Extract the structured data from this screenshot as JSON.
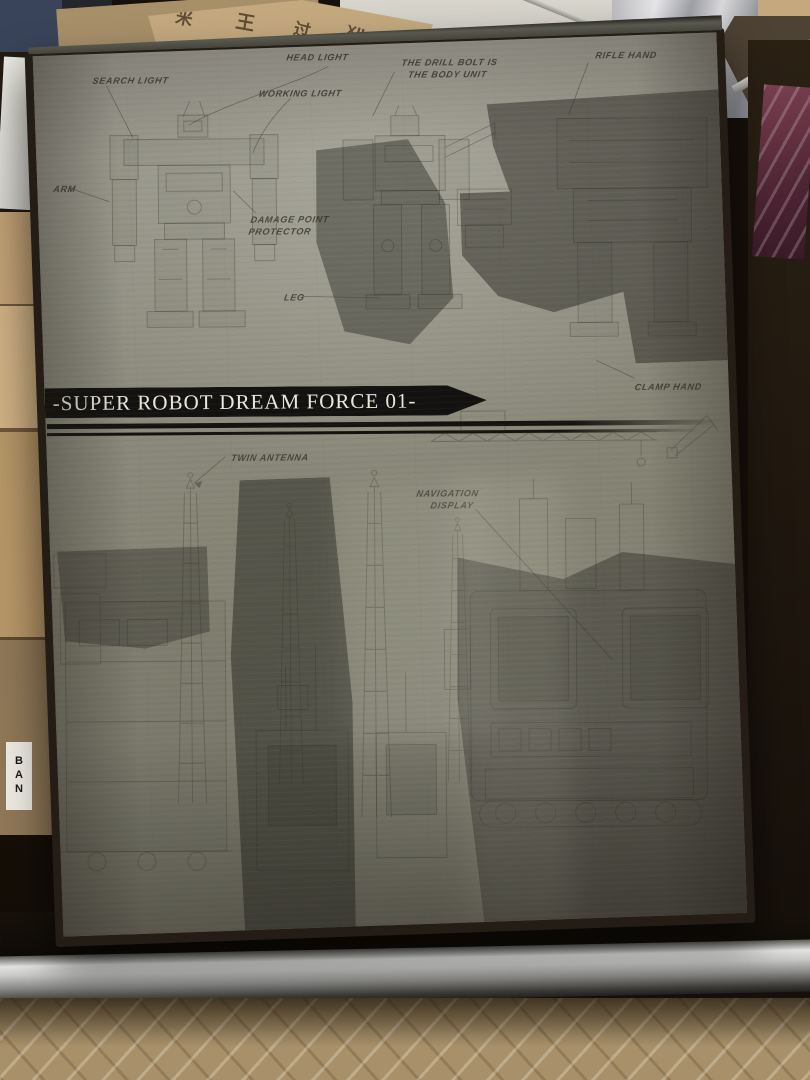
{
  "box": {
    "title": "-SUPER ROBOT DREAM FORCE 01-",
    "callouts": {
      "search_light": "SEARCH LIGHT",
      "head_light": "HEAD LIGHT",
      "working_light": "WORKING LIGHT",
      "body_note": {
        "line1": "THE DRILL BOLT IS",
        "line2": "THE BODY UNIT"
      },
      "rifle_hand": "RIFLE HAND",
      "arm": "ARM",
      "damage_point_protector": {
        "line1": "DAMAGE POINT",
        "line2": "PROTECTOR"
      },
      "leg": "LEG",
      "clamp_hand": "CLAMP HAND",
      "twin_antenna": "TWIN ANTENNA",
      "navigation_display": {
        "line1": "NAVIGATION",
        "line2": "DISPLAY"
      }
    }
  },
  "surroundings": {
    "carton_markings": [
      "米",
      "王",
      "过",
      "XII"
    ],
    "carton_side_label": "BAN"
  },
  "colors": {
    "box_face": "#8d8c7f",
    "box_edge": "#241d15",
    "banner_bg": "#141210",
    "banner_text": "#eae8dc",
    "label_ink": "#3b3a31",
    "blueprint_ink": "#45443a",
    "floor": "#a8916a",
    "carton": "#c2a275"
  }
}
